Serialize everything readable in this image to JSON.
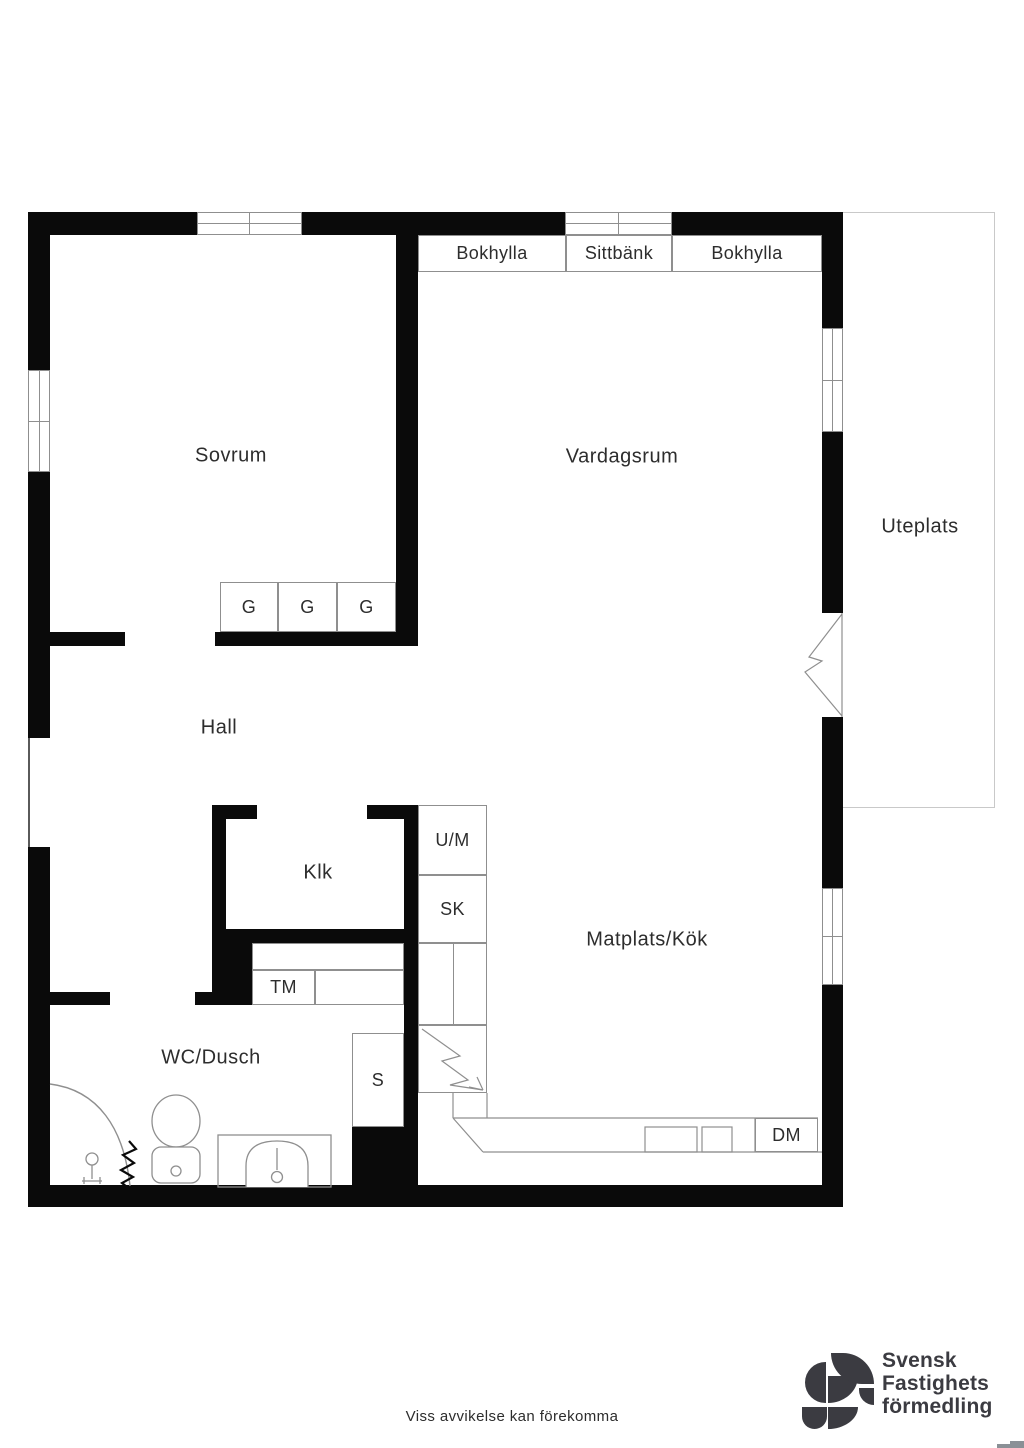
{
  "floorplan": {
    "rooms": [
      {
        "id": "sovrum",
        "label": "Sovrum"
      },
      {
        "id": "vardagsrum",
        "label": "Vardagsrum"
      },
      {
        "id": "uteplats",
        "label": "Uteplats"
      },
      {
        "id": "hall",
        "label": "Hall"
      },
      {
        "id": "klk",
        "label": "Klk"
      },
      {
        "id": "wc-dusch",
        "label": "WC/Dusch"
      },
      {
        "id": "matplats-kok",
        "label": "Matplats/Kök"
      }
    ],
    "fixtures": [
      {
        "id": "bokhylla-left",
        "label": "Bokhylla"
      },
      {
        "id": "sittbank",
        "label": "Sittbänk"
      },
      {
        "id": "bokhylla-right",
        "label": "Bokhylla"
      },
      {
        "id": "garderob-1",
        "label": "G"
      },
      {
        "id": "garderob-2",
        "label": "G"
      },
      {
        "id": "garderob-3",
        "label": "G"
      },
      {
        "id": "um",
        "label": "U/M"
      },
      {
        "id": "sk",
        "label": "SK"
      },
      {
        "id": "tm",
        "label": "TM"
      },
      {
        "id": "stadskap",
        "label": "S"
      },
      {
        "id": "dm",
        "label": "DM"
      }
    ],
    "icons": [
      "window-symbol",
      "balcony-door-icon",
      "entry-opening",
      "stove-icon",
      "kitchen-counter",
      "sink-icon",
      "toilet-icon",
      "shower-icon",
      "floor-drain-icon"
    ]
  },
  "footer": {
    "disclaimer": "Viss avvikelse kan förekomma"
  },
  "brand": {
    "line1": "Svensk",
    "line2": "Fastighets",
    "line3": "förmedling"
  },
  "colors": {
    "wall": "#0a0a0a",
    "line": "#8f8f8f",
    "text": "#2d2d2d",
    "patio": "#c9c9c9",
    "opening": "#5a5a5a",
    "logo": "#3b3b41",
    "corner": "#8a9096"
  }
}
